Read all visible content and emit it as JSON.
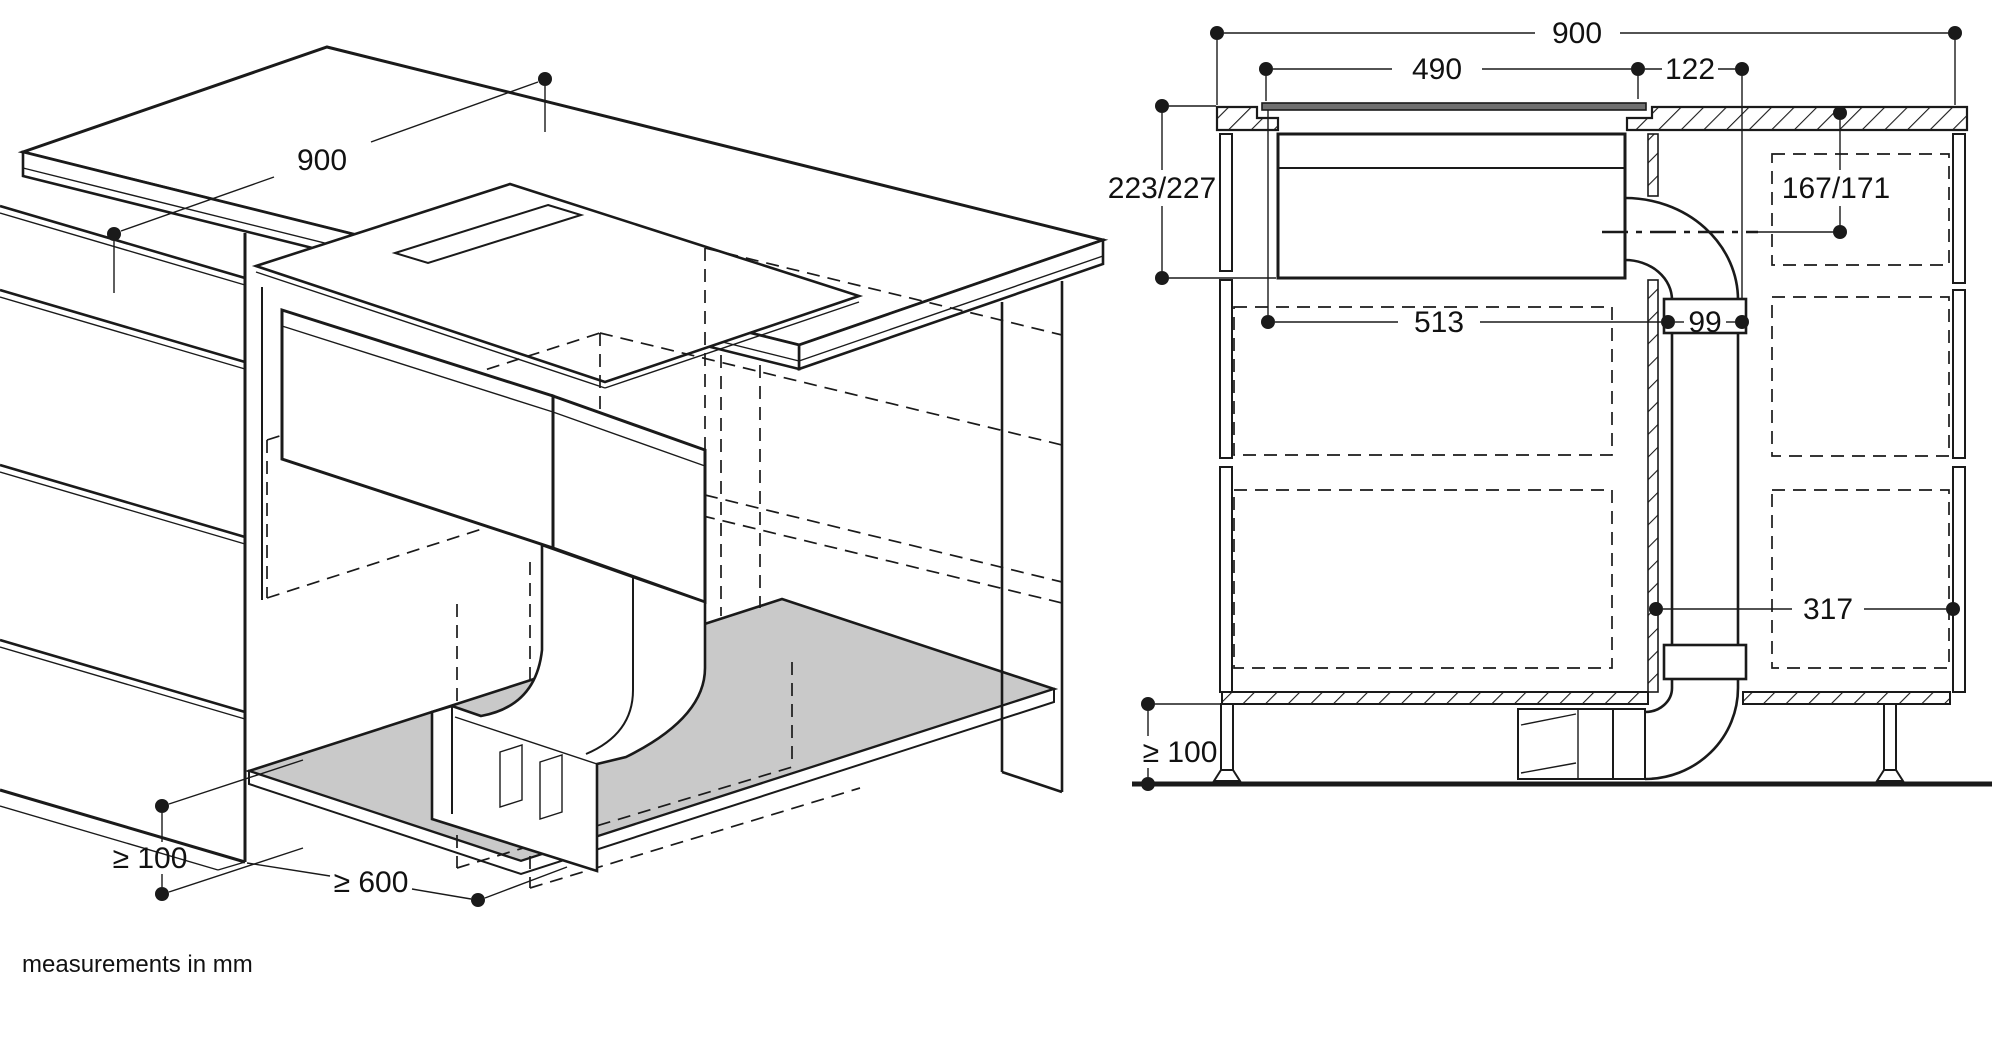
{
  "title_note": "measurements in mm",
  "colors": {
    "ink": "#1a1a1a",
    "shelf_fill": "#c9c9c9",
    "glass_fill": "#707070",
    "background": "#ffffff"
  },
  "isometric_view": {
    "label": "island installation, isometric view",
    "dims": {
      "worktop_depth": "900",
      "floor_clearance": "≥ 100",
      "outlet_distance": "≥ 600"
    }
  },
  "section_view": {
    "label": "installation cross-section",
    "dims": {
      "worktop_width": "900",
      "cutout_width": "490",
      "duct_offset": "122",
      "appliance_height": "223/227",
      "duct_axis_height": "167/171",
      "appliance_depth": "513",
      "duct_width": "99",
      "duct_to_side": "317",
      "floor_clearance": "≥ 100"
    }
  }
}
